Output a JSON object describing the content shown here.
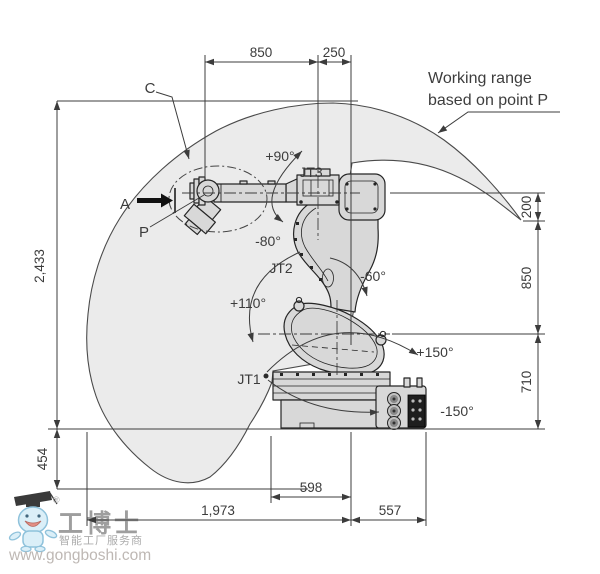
{
  "colors": {
    "envelope_fill": "#ebebeb",
    "robot_fill": "#d8d8d8",
    "dimension_line": "#3c3c3c",
    "part_outline": "#252525",
    "watermark_blue": "#d8eef8",
    "watermark_text": "#969696"
  },
  "callouts": {
    "working_range_line1": "Working range",
    "working_range_line2": "based on point P",
    "point_a": "A",
    "point_c": "C",
    "point_p": "P"
  },
  "joints": {
    "jt1": "JT1",
    "jt2": "JT2",
    "jt3": "JT3"
  },
  "angles": {
    "jt3_positive": "+90°",
    "jt3_negative": "-80°",
    "jt2_negative": "-60°",
    "jt2_positive": "+110°",
    "jt1_positive": "+150°",
    "jt1_negative": "-150°"
  },
  "dimensions": {
    "top_span": "850",
    "top_offset": "250",
    "right_upper": "200",
    "right_middle": "850",
    "right_lower": "710",
    "left_height": "2,433",
    "left_below_base": "454",
    "bottom_base": "598",
    "bottom_reach": "1,973",
    "bottom_right": "557"
  },
  "watermark": {
    "brand": "工博士",
    "registered": "®",
    "tagline": "智能工厂服务商",
    "url": "www.gongboshi.com"
  }
}
